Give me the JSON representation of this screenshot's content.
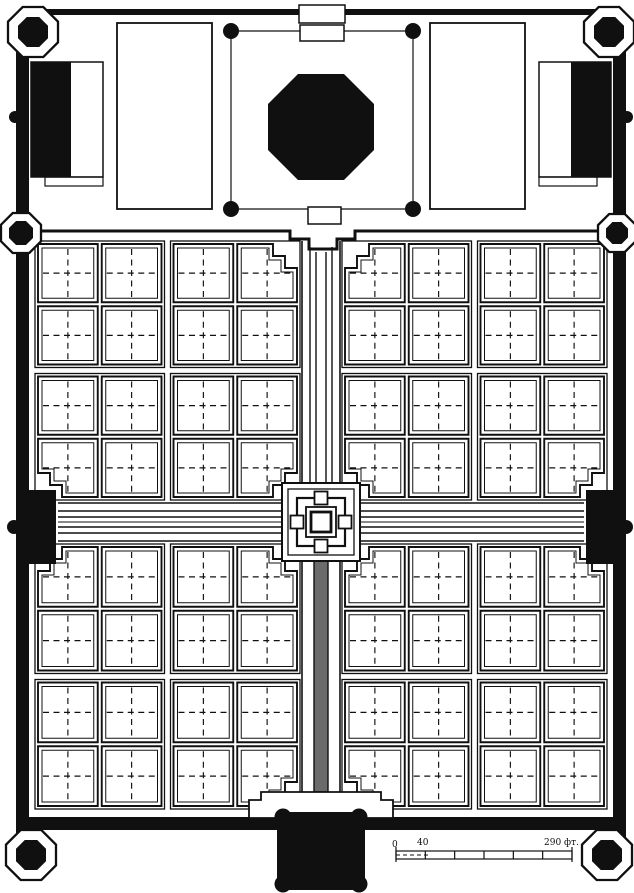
{
  "scale_bar": {
    "start_label": "0",
    "first_tick_label": "40",
    "end_label": "290 фт.",
    "divisions": 6
  },
  "colors": {
    "ink": "#101010",
    "paper": "#ffffff",
    "channel_fill": "#6b6b6b"
  },
  "plan": {
    "type": "architectural-plan",
    "subject": "walled charbagh tomb-garden complex: tomb terrace at top, fourfold garden below, main gateway at bottom",
    "garden": {
      "quadrants": 4,
      "plots_per_quadrant": 16,
      "total_plots": 64,
      "plot_marking": "dashed quartering cross in each plot"
    },
    "axes": {
      "axial_walkways": 2,
      "water_channel": "central channel along both axes, shaded in lower axis",
      "central_pool": "square pool on stepped platform at the crossing"
    },
    "perimeter": {
      "corner_towers": 4,
      "mid_wall_towers": 2,
      "side_gates": 2,
      "main_south_gateway": 1,
      "terrace_buildings": 3,
      "terrace_courtyards": 2
    }
  }
}
